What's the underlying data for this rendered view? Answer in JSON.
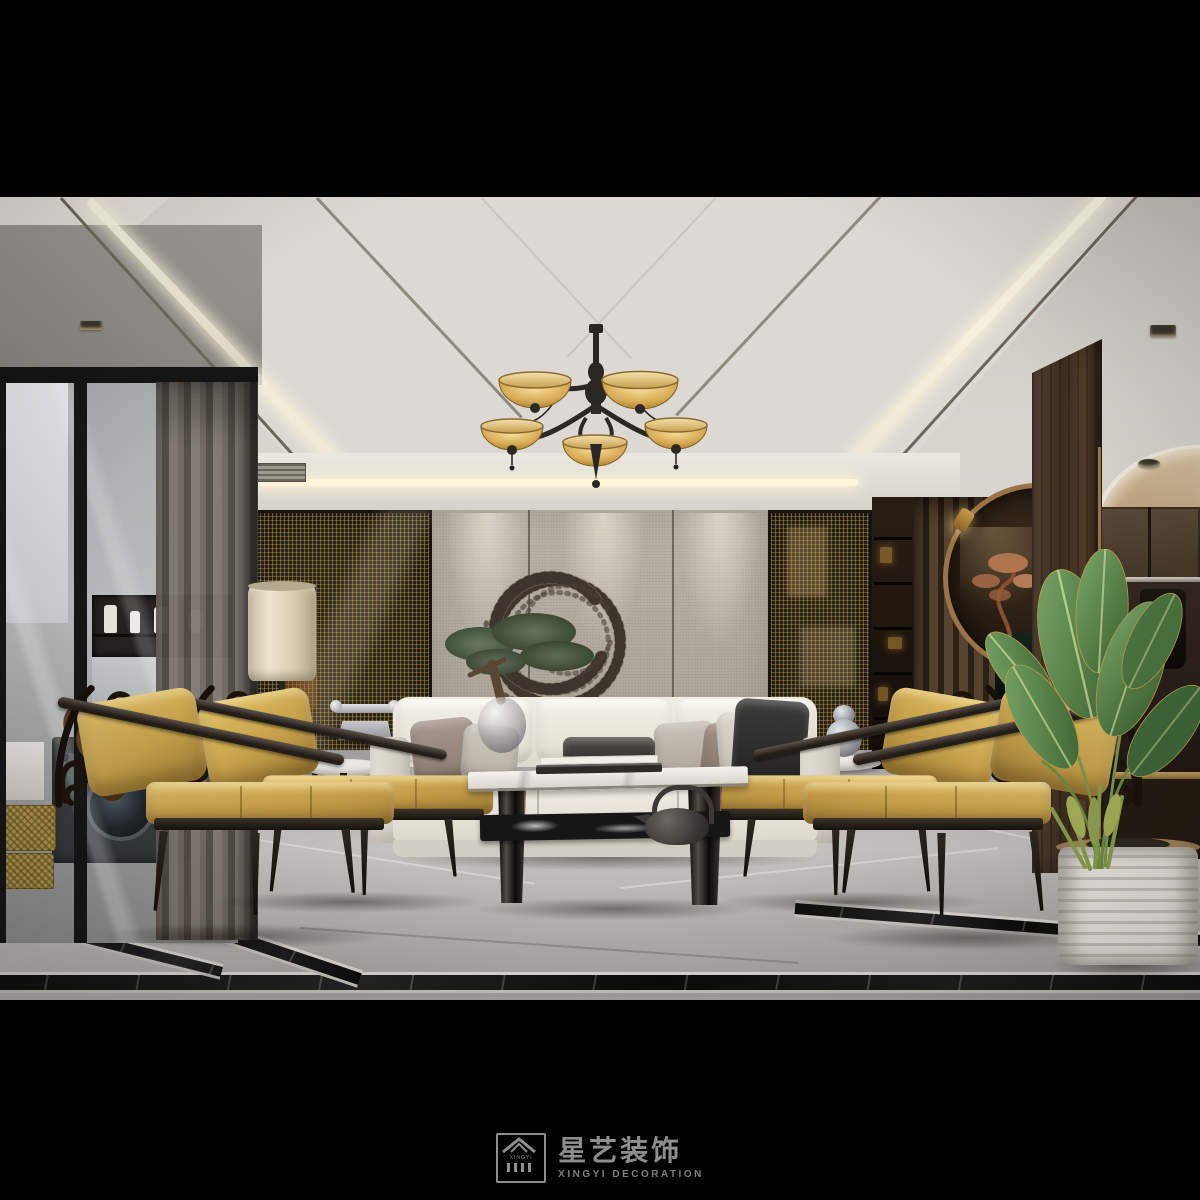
{
  "watermark": {
    "brand": "星艺装饰",
    "subtitle": "XINGYI DECORATION",
    "icon_label": "XINGYI"
  },
  "palette": {
    "letterbox": "#000000",
    "ceiling": "#d8d5d0",
    "cove_light": "#fff3d8",
    "fabric_wall": "#b3ac9f",
    "bronze_mesh": "#6e5a33",
    "dark_wood": "#46362a",
    "sofa_cream": "#ece8df",
    "chair_gold": "#c9a64c",
    "chandelier_amber": "#e8c87c",
    "marble_floor": "#a9a7a4",
    "plant_green": "#5e8a4e",
    "brass_accent": "#a98a55",
    "watermark_gray": "#8e8e8e"
  },
  "scene": {
    "description": "Modern Chinese-style living room render: amber-glass chandelier, cream sofa with taupe and charcoal pillows, four carved dark-wood armchairs with gold cushions, two-tier marble coffee table with iron teapot, interlocking-ring metal wall art on fabric panels, bronze mesh screens, wood slat partition with moon-gate niche and copper bonsai, bird-of-paradise plant in ribbed white planter, gray marble floor with black inlay borders, glass-walled laundry at left."
  }
}
